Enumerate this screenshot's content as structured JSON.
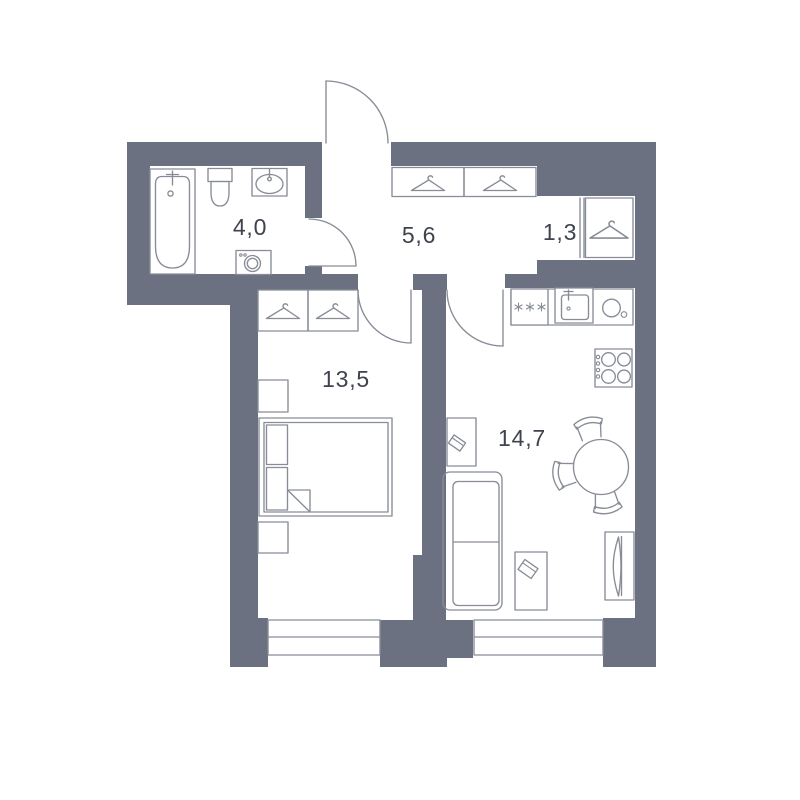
{
  "plan": {
    "title": "one-bedroom apartment floor plan",
    "rooms": [
      {
        "id": "bathroom",
        "area": "4,0"
      },
      {
        "id": "hallway",
        "area": "5,6"
      },
      {
        "id": "wardrobe-niche",
        "area": "1,3"
      },
      {
        "id": "bedroom",
        "area": "13,5"
      },
      {
        "id": "kitchen-living-room",
        "area": "14,7"
      }
    ],
    "colors": {
      "wall": "#6B7180",
      "line": "#878C96",
      "text": "#3E434D",
      "bg": "#FFFFFF"
    },
    "fixtures": [
      "bathtub",
      "toilet",
      "washbasin",
      "washing-machine",
      "clothes-hanger",
      "entrance-door",
      "interior-door",
      "window",
      "wardrobe",
      "bed",
      "nightstand",
      "kitchen-counter",
      "dishwasher",
      "kitchen-sink",
      "cooktop",
      "dining-table",
      "chair",
      "sofa",
      "coffee-table",
      "desk",
      "tv-stand"
    ]
  }
}
